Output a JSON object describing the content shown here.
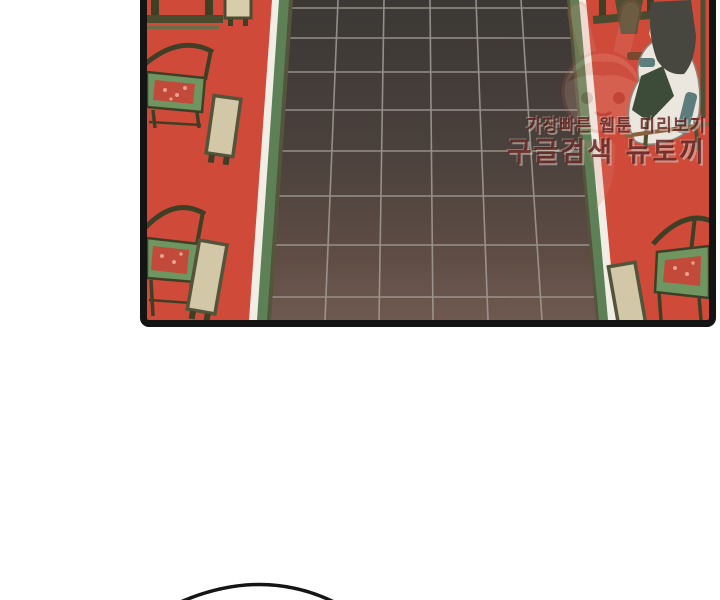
{
  "page": {
    "background": "#ffffff",
    "type": "webtoon-comic-panel"
  },
  "panel": {
    "border_color": "#141414",
    "background_color": "#d04a3a",
    "floor": {
      "tile_top_color": "#3b3835",
      "tile_bottom_color": "#6f5950",
      "grid_line_color": "#a39e96",
      "trim_green": "#5e8056",
      "trim_shadow": "#55543c",
      "stripe_white": "#f2eee6"
    },
    "furniture": {
      "chair_frame_color": "#3f3f26",
      "cushion_green": "#6f9560",
      "cushion_pattern_red": "#c14a3a",
      "bench_top_beige": "#d2c7a6"
    },
    "character": {
      "robe_white": "#ebe7de",
      "hair_dark": "#474740",
      "accent_teal": "#5d7d7d",
      "underrobe_green": "#3c4c38",
      "skin": "#e9c9a6"
    },
    "watermark": {
      "line1": "가장빠른 웹툰 미리보기",
      "line2": "구글검색 뉴토끼",
      "text_color": "#5f1f1c",
      "mascot": "rabbit-mascot"
    }
  },
  "speech_bubble": {
    "shape": "partial-arc",
    "stroke_color": "#151515"
  }
}
